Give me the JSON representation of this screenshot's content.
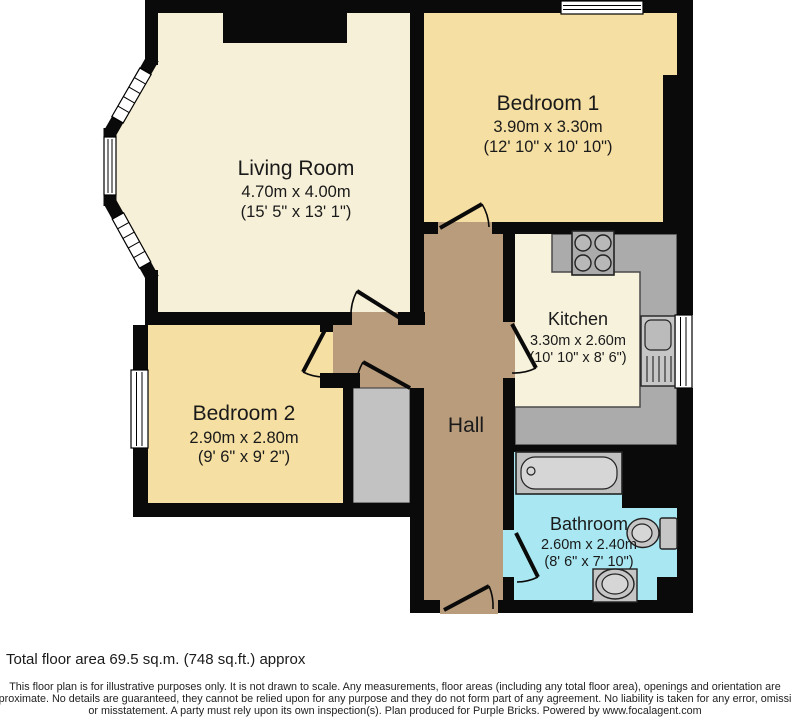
{
  "plan": {
    "title": "Two bedroom flat floor plan",
    "rooms": [
      {
        "id": "living-room",
        "name": "Living Room",
        "metric": "4.70m x 4.00m",
        "imperial": "(15' 5\" x 13' 1\")"
      },
      {
        "id": "bedroom-1",
        "name": "Bedroom 1",
        "metric": "3.90m x 3.30m",
        "imperial": "(12' 10\" x 10' 10\")"
      },
      {
        "id": "kitchen",
        "name": "Kitchen",
        "metric": "3.30m x 2.60m",
        "imperial": "(10' 10\" x 8' 6\")"
      },
      {
        "id": "bedroom-2",
        "name": "Bedroom 2",
        "metric": "2.90m x 2.80m",
        "imperial": "(9' 6\" x 9' 2\")"
      },
      {
        "id": "hall",
        "name": "Hall",
        "metric": "",
        "imperial": ""
      },
      {
        "id": "bathroom",
        "name": "Bathroom",
        "metric": "2.60m x 2.40m",
        "imperial": "(8' 6\" x 7' 10\")"
      }
    ],
    "colors": {
      "walls": "#0a0a0a",
      "living_room": "#F7F0D8",
      "bedrooms": "#F5DFA2",
      "kitchen_floor": "#F7F2DC",
      "counter": "#ABABAB",
      "hall": "#B99C7C",
      "bathroom": "#A9E8F2",
      "cupboard": "#C2C2C2",
      "window": "#FFFFFF"
    },
    "footer": {
      "total_area": "Total floor area 69.5 sq.m. (748 sq.ft.) approx",
      "disclaimer_line1": "This floor plan is for illustrative purposes only. It is not drawn to scale. Any measurements, floor areas (including any total floor area), openings and orientation are",
      "disclaimer_line2": "approximate. No details are guaranteed, they cannot be relied upon for any purpose and they do not form part of any agreement. No liability is taken for any error, omission",
      "disclaimer_line3": "or misstatement. A party must rely upon its own inspection(s). Plan produced for Purple Bricks. Powered by www.focalagent.com"
    }
  }
}
